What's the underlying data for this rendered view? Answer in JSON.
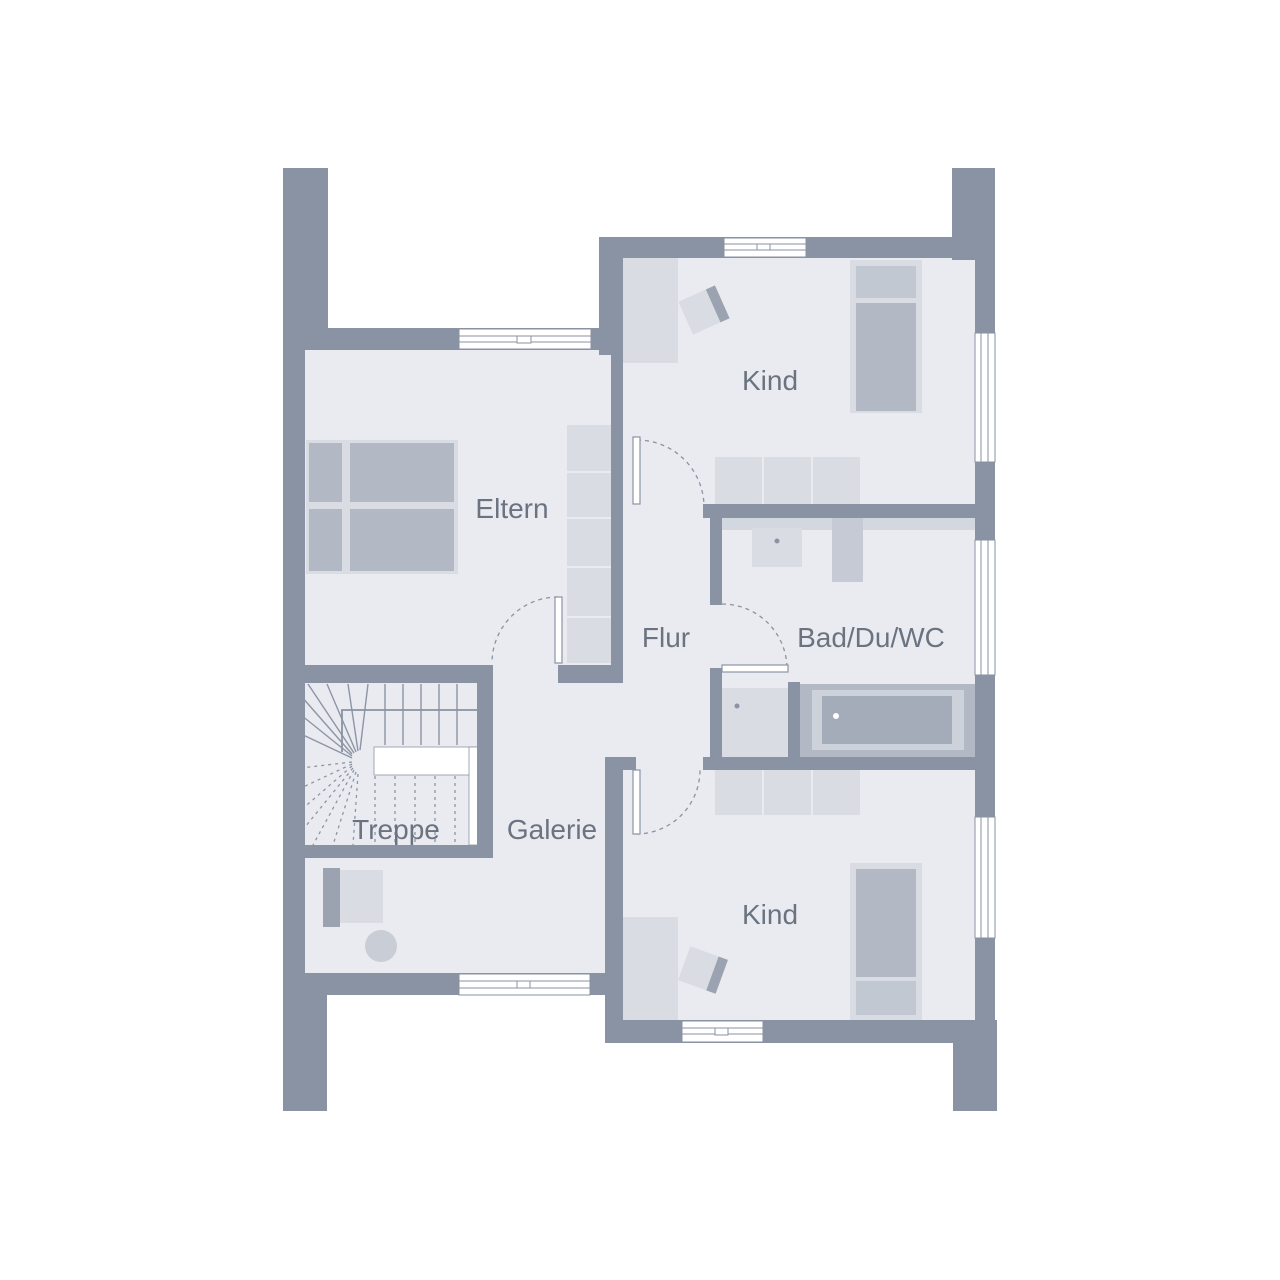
{
  "meta": {
    "kind": "floor-plan",
    "floor": "upper floor"
  },
  "palette": {
    "wall": "#8a93a3",
    "floor": "#e9ebf1",
    "outline": "#8d95a4",
    "furn_light": "#d9dce3",
    "furn_mid": "#b2b9c5",
    "furn_midlight": "#c2c8d2",
    "furn_dark": "#9ba3b0",
    "counter": "#d3d7df",
    "wc": "#c5cad4",
    "tub_outer": "#b2b8c4",
    "tub_ledge": "#cdd1d9",
    "tub_basin": "#a5acb9",
    "plant": "#c9cdd5",
    "text": "#6b7380"
  },
  "rooms": {
    "kind_top": {
      "label": "Kind"
    },
    "eltern": {
      "label": "Eltern"
    },
    "flur": {
      "label": "Flur"
    },
    "bad": {
      "label": "Bad/Du/WC"
    },
    "treppe": {
      "label": "Treppe"
    },
    "galerie": {
      "label": "Galerie"
    },
    "kind_bottom": {
      "label": "Kind"
    }
  }
}
